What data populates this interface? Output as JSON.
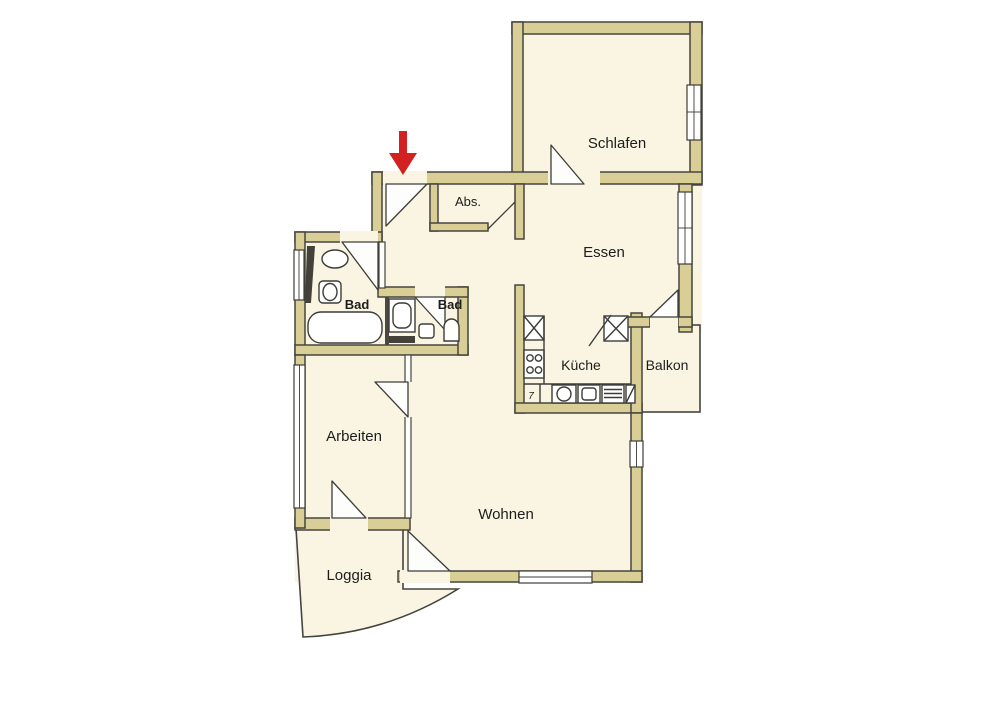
{
  "type": "apartment-floor-plan",
  "rooms": {
    "schlafen": {
      "label": "Schlafen"
    },
    "abs": {
      "label": "Abs."
    },
    "essen": {
      "label": "Essen"
    },
    "bad1": {
      "label": "Bad"
    },
    "bad2": {
      "label": "Bad"
    },
    "kueche": {
      "label": "Küche"
    },
    "balkon": {
      "label": "Balkon"
    },
    "arbeiten": {
      "label": "Arbeiten"
    },
    "wohnen": {
      "label": "Wohnen"
    },
    "loggia": {
      "label": "Loggia"
    }
  },
  "annotations": {
    "kitchen_mark": "7"
  },
  "colors": {
    "wall_fill": "#d9ce96",
    "wall_outline": "#45453e",
    "floor": "#faf5e3",
    "background": "#ffffff",
    "window": "#ffffff",
    "entrance_arrow": "#d32121",
    "dark_fixture": "#43413a"
  }
}
